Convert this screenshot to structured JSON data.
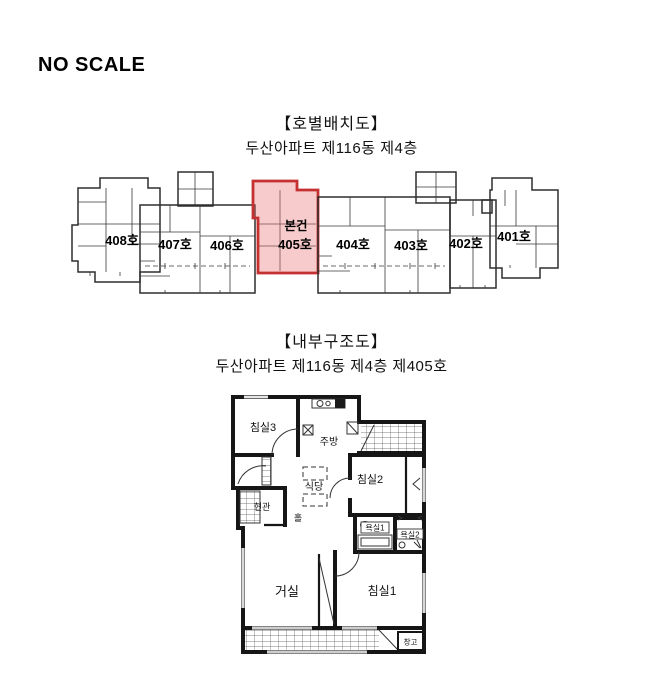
{
  "document": {
    "scale_note": "NO SCALE"
  },
  "unit_layout_section": {
    "title": "【호별배치도】",
    "subtitle": "두산아파트 제116동 제4층",
    "subject_marker": "본건",
    "unit_labels": {
      "408": "408호",
      "407": "407호",
      "406": "406호",
      "405": "405호",
      "404": "404호",
      "403": "403호",
      "402": "402호",
      "401": "401호"
    },
    "highlight": {
      "outline": "#c53030",
      "fill": "rgba(235,118,118,0.38)"
    }
  },
  "internal_plan_section": {
    "title": "【내부구조도】",
    "subtitle": "두산아파트 제116동 제4층 제405호",
    "rooms": {
      "bedroom3": "침실3",
      "kitchen": "주방",
      "dining": "식당",
      "bedroom2": "침실2",
      "entrance": "현관",
      "hall": "홀",
      "bath1": "욕실1",
      "bath2": "욕실2",
      "living": "거실",
      "bedroom1": "침실1",
      "storage": "창고"
    }
  }
}
